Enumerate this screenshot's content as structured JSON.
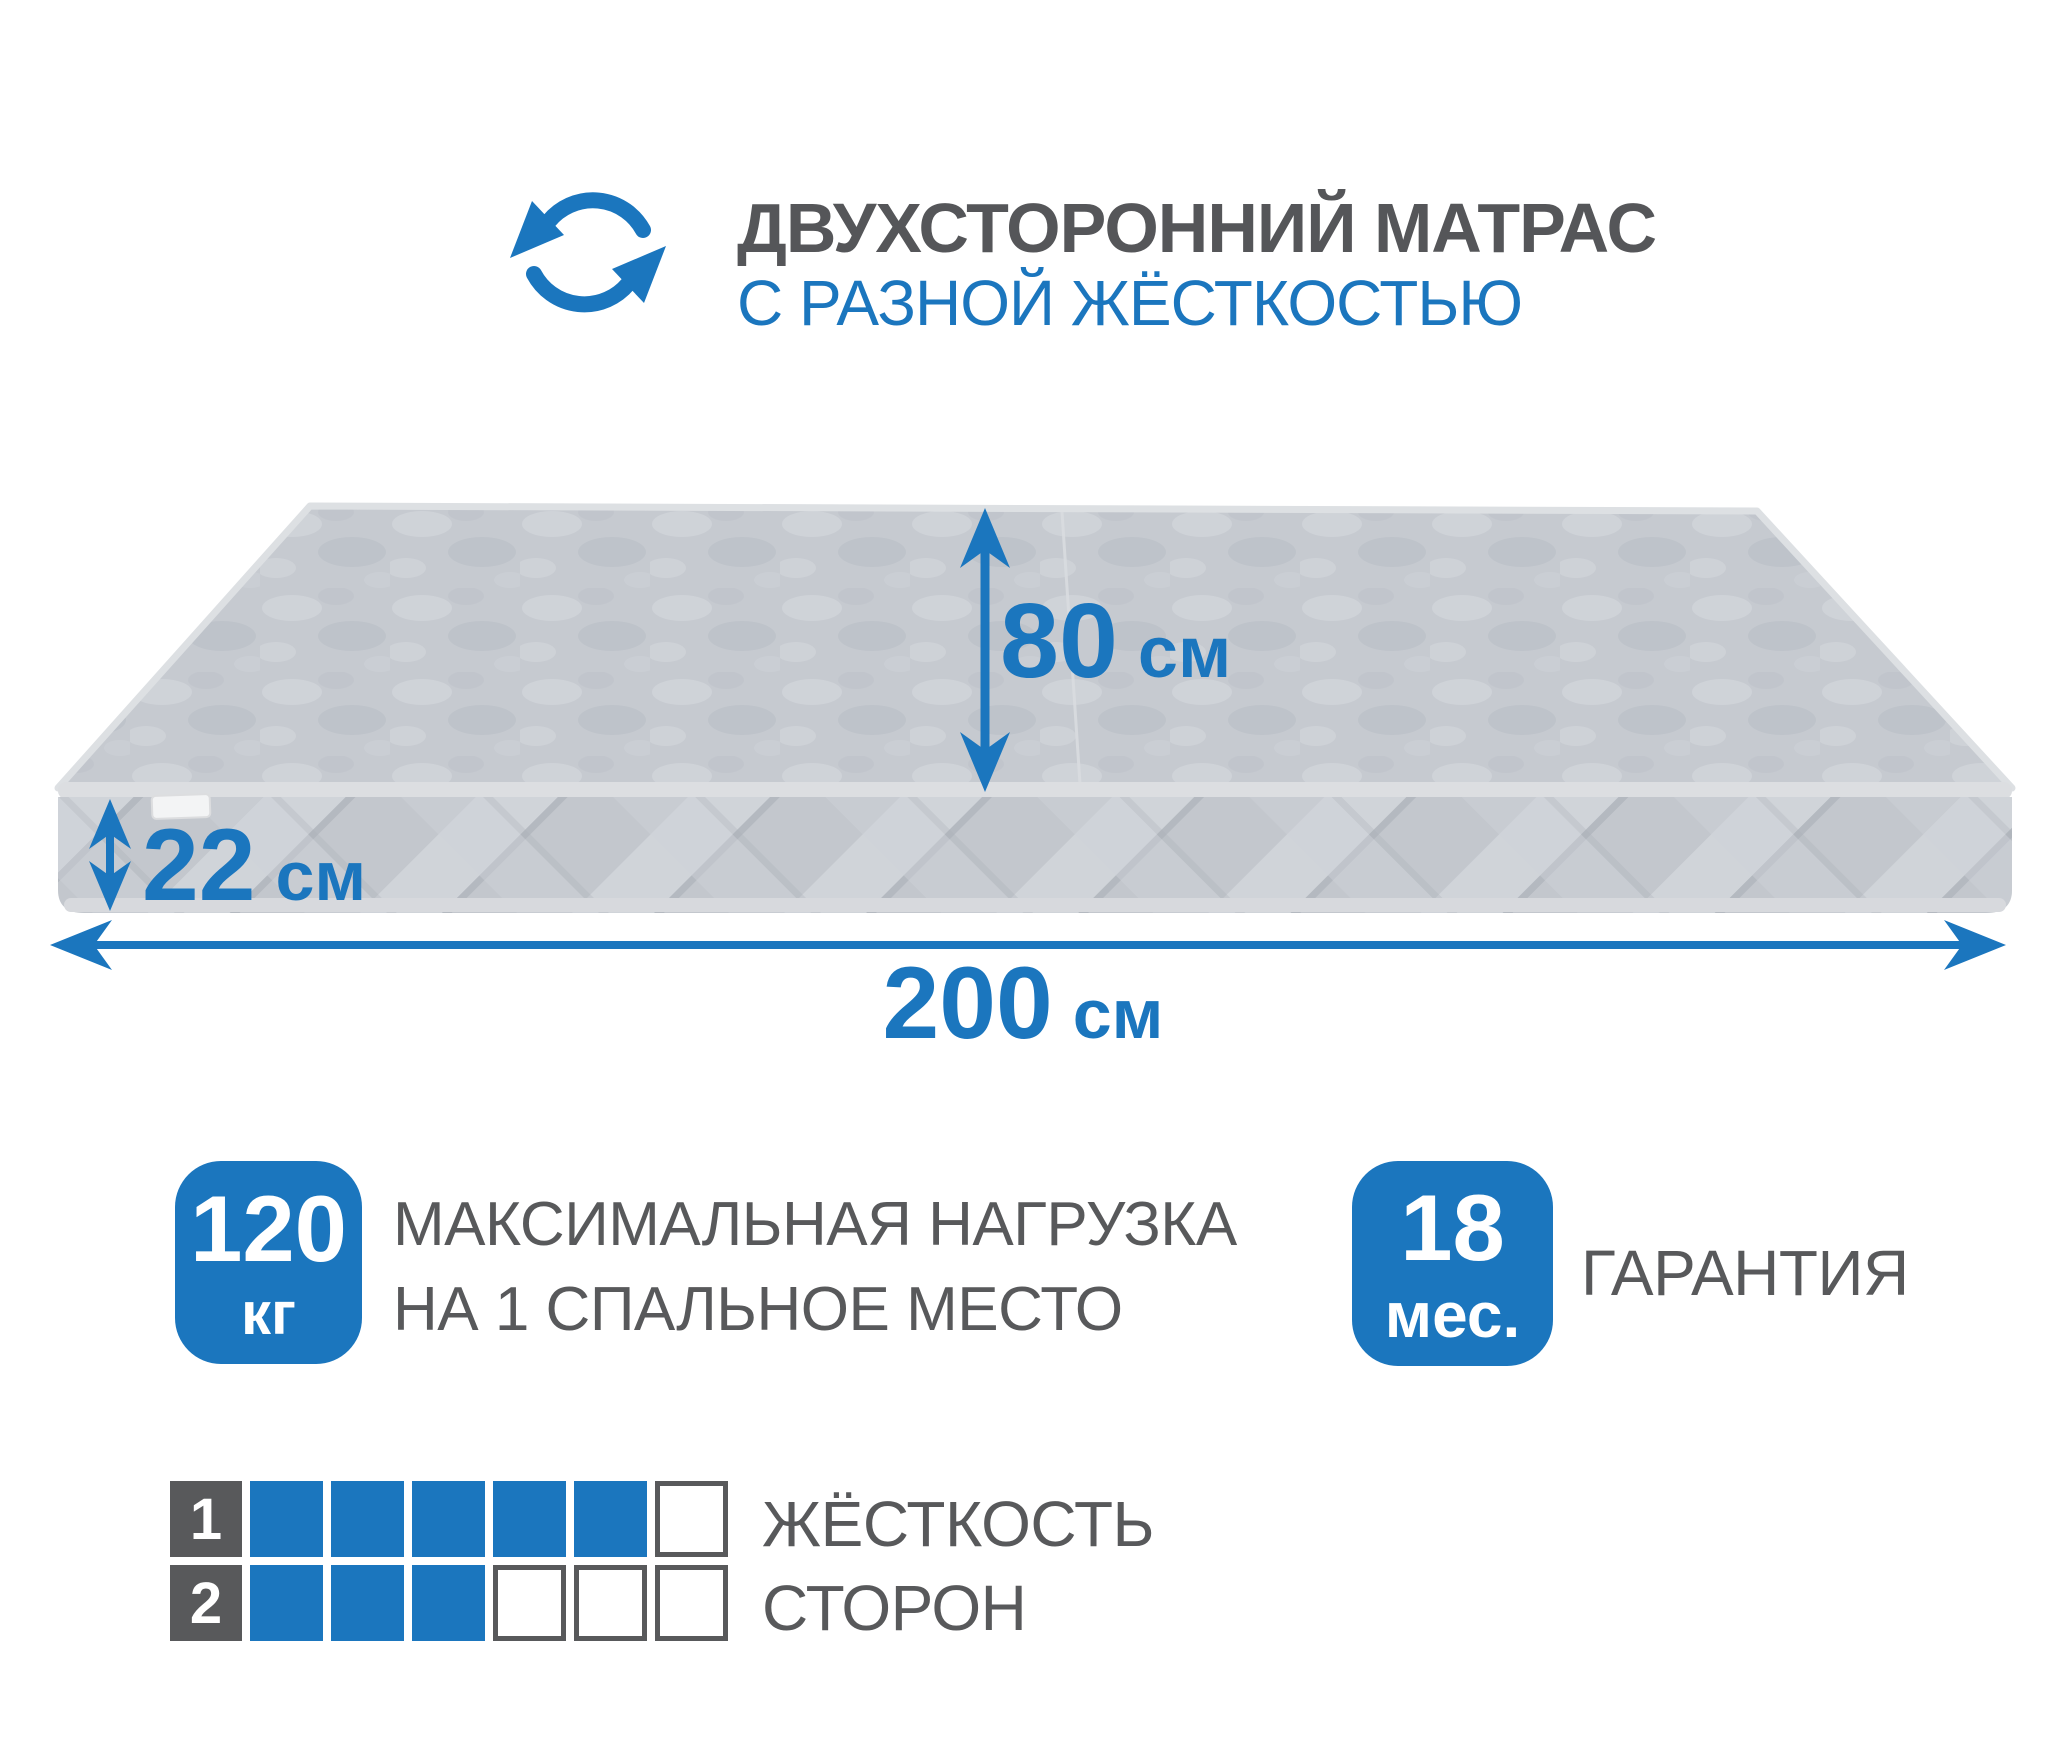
{
  "header": {
    "rotation_icon": "rotation-arrows-icon",
    "title_line1": "ДВУХСТОРОННИЙ МАТРАС",
    "title_line2": "С РАЗНОЙ ЖЁСТКОСТЬЮ"
  },
  "mattress_diagram": {
    "width": {
      "value": "80",
      "unit": "см"
    },
    "height": {
      "value": "22",
      "unit": "см"
    },
    "length": {
      "value": "200",
      "unit": "см"
    }
  },
  "badges": {
    "max_load": {
      "value": "120",
      "unit": "кг",
      "label_line1": "МАКСИМАЛЬНАЯ НАГРУЗКА",
      "label_line2": "НА 1 СПАЛЬНОЕ МЕСТО"
    },
    "warranty": {
      "value": "18",
      "unit": "мес.",
      "label": "ГАРАНТИЯ"
    }
  },
  "firmness_scale": {
    "label_line1": "ЖЁСТКОСТЬ",
    "label_line2": "СТОРОН",
    "rows": [
      {
        "side": "1",
        "filled": 5,
        "total": 6
      },
      {
        "side": "2",
        "filled": 3,
        "total": 6
      }
    ]
  },
  "colors": {
    "accent_blue": "#1b76be",
    "text_gray": "#58595b",
    "title_gray": "#555659",
    "mattress_top": "#c6cad0",
    "mattress_side": "#c3c7cd",
    "piping": "#dcdee1"
  }
}
